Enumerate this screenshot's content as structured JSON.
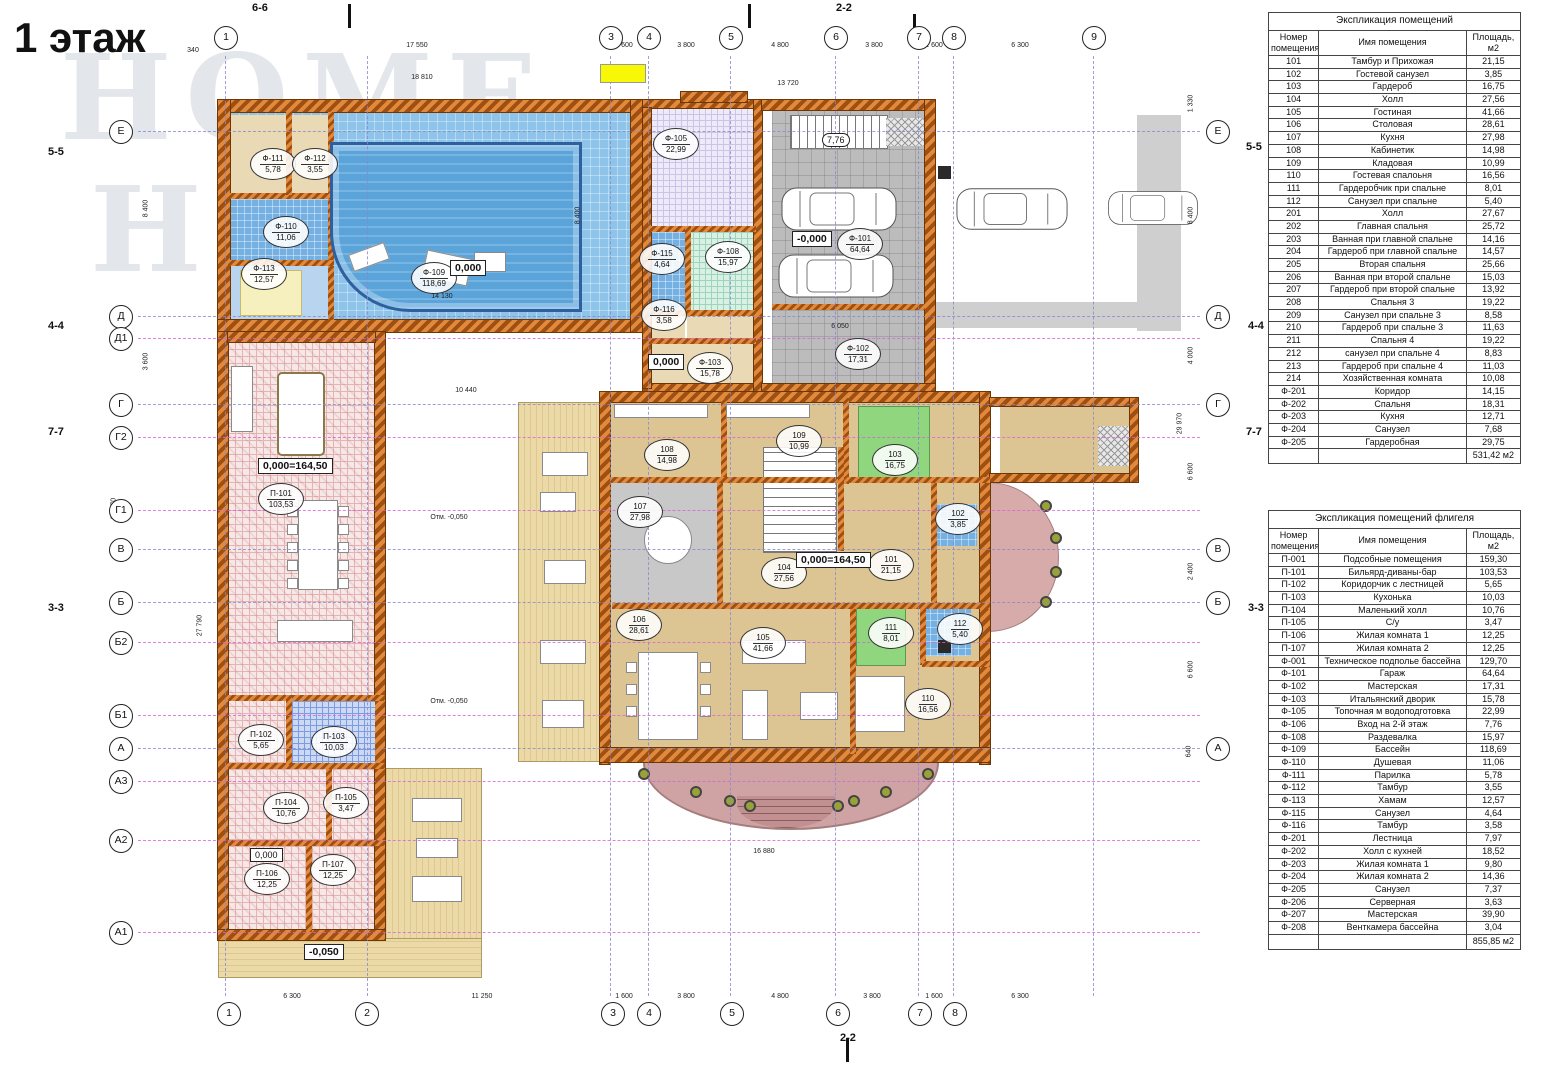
{
  "title": "1 этаж",
  "watermark": {
    "line1": "HOME",
    "line2": "HUNTER"
  },
  "colors": {
    "wall_orange": "#c8601a",
    "pool_blue": "#5aa4da",
    "pool_room": "#8ec3ea",
    "garage_gray": "#bcbcbc",
    "floor_tan": "#dcc593",
    "wing_pink": "#f7e8e8",
    "green_room": "#8fd67e",
    "bath_blue": "#74b0e2",
    "terrace_pink": "#cfa3a3",
    "deck_wood": "#ecd9a8",
    "highlight_yellow": "#f8f806",
    "grid_blue": "#8888cc",
    "grid_magenta": "#d664d6"
  },
  "axes": {
    "top": [
      "1",
      "3",
      "4",
      "5",
      "6",
      "7",
      "8",
      "9"
    ],
    "bottom": [
      "1",
      "2",
      "3",
      "4",
      "5",
      "6",
      "7",
      "8"
    ],
    "left": [
      "Е",
      "Д",
      "Д1",
      "Г",
      "Г2",
      "Г1",
      "В",
      "Б",
      "Б2",
      "Б1",
      "А",
      "А3",
      "А2",
      "А1"
    ],
    "right": [
      "Е",
      "Д",
      "Г",
      "В",
      "Б",
      "А"
    ]
  },
  "sections": {
    "s55": "5-5",
    "s44": "4-4",
    "s77": "7-7",
    "s33": "3-3",
    "s66": "6-6",
    "s22": "2-2"
  },
  "levels": {
    "pool": "0,000",
    "court": "0,000",
    "garage": "-0,000",
    "house": "0,000=164,50",
    "wing": "0,000=164,50",
    "p106": "0,000",
    "deck": "-0,050",
    "stair": "7,76",
    "otm": "Отм. -0,050"
  },
  "dims": {
    "top": [
      "340",
      "17 550",
      "1 600",
      "3 800",
      "4 800",
      "3 800",
      "1 600",
      "6 300"
    ],
    "top2": [
      "18 810",
      "13 720"
    ],
    "bottom": [
      "6 300",
      "11 250",
      "1 600",
      "3 800",
      "4 800",
      "3 800",
      "1 600",
      "6 300"
    ],
    "left": [
      "8 400",
      "3 600",
      "38 770",
      "27 790"
    ],
    "right": [
      "1 330",
      "8 400",
      "4 000",
      "6 600",
      "2 400",
      "6 600",
      "640",
      "29 970"
    ],
    "inner": [
      "14 130",
      "10 440",
      "16 880",
      "6 050",
      "8 400"
    ]
  },
  "rooms": {
    "f101": {
      "id": "Ф-101",
      "area": "64,64"
    },
    "f102": {
      "id": "Ф-102",
      "area": "17,31"
    },
    "f103": {
      "id": "Ф-103",
      "area": "15,78"
    },
    "f105": {
      "id": "Ф-105",
      "area": "22,99"
    },
    "f108": {
      "id": "Ф-108",
      "area": "15,97"
    },
    "f109": {
      "id": "Ф-109",
      "area": "118,69"
    },
    "f110": {
      "id": "Ф-110",
      "area": "11,06"
    },
    "f111": {
      "id": "Ф-111",
      "area": "5,78"
    },
    "f112": {
      "id": "Ф-112",
      "area": "3,55"
    },
    "f113": {
      "id": "Ф-113",
      "area": "12,57"
    },
    "f115": {
      "id": "Ф-115",
      "area": "4,64"
    },
    "f116": {
      "id": "Ф-116",
      "area": "3,58"
    },
    "r101": {
      "id": "101",
      "area": "21,15"
    },
    "r102": {
      "id": "102",
      "area": "3,85"
    },
    "r103": {
      "id": "103",
      "area": "16,75"
    },
    "r104": {
      "id": "104",
      "area": "27,56"
    },
    "r105": {
      "id": "105",
      "area": "41,66"
    },
    "r106": {
      "id": "106",
      "area": "28,61"
    },
    "r107": {
      "id": "107",
      "area": "27,98"
    },
    "r108": {
      "id": "108",
      "area": "14,98"
    },
    "r109": {
      "id": "109",
      "area": "10,99"
    },
    "r110": {
      "id": "110",
      "area": "16,56"
    },
    "r111": {
      "id": "111",
      "area": "8,01"
    },
    "r112": {
      "id": "112",
      "area": "5,40"
    },
    "p101": {
      "id": "П-101",
      "area": "103,53"
    },
    "p102": {
      "id": "П-102",
      "area": "5,65"
    },
    "p103": {
      "id": "П-103",
      "area": "10,03"
    },
    "p104": {
      "id": "П-104",
      "area": "10,76"
    },
    "p105": {
      "id": "П-105",
      "area": "3,47"
    },
    "p106": {
      "id": "П-106",
      "area": "12,25"
    },
    "p107": {
      "id": "П-107",
      "area": "12,25"
    }
  },
  "tables": [
    {
      "title": "Экспликация помещений",
      "headers": [
        "Номер помещения",
        "Имя помещения",
        "Площадь, м2"
      ],
      "rows": [
        [
          "101",
          "Тамбур и Прихожая",
          "21,15"
        ],
        [
          "102",
          "Гостевой санузел",
          "3,85"
        ],
        [
          "103",
          "Гардероб",
          "16,75"
        ],
        [
          "104",
          "Холл",
          "27,56"
        ],
        [
          "105",
          "Гостиная",
          "41,66"
        ],
        [
          "106",
          "Столовая",
          "28,61"
        ],
        [
          "107",
          "Кухня",
          "27,98"
        ],
        [
          "108",
          "Кабинетик",
          "14,98"
        ],
        [
          "109",
          "Кладовая",
          "10,99"
        ],
        [
          "110",
          "Гостевая спалоьня",
          "16,56"
        ],
        [
          "111",
          "Гардеробчик при спальне",
          "8,01"
        ],
        [
          "112",
          "Санузел при спальне",
          "5,40"
        ],
        [
          "201",
          "Холл",
          "27,67"
        ],
        [
          "202",
          "Главная спальня",
          "25,72"
        ],
        [
          "203",
          "Ванная при главной спальне",
          "14,16"
        ],
        [
          "204",
          "Гардероб при главной спальне",
          "14,57"
        ],
        [
          "205",
          "Вторая спальня",
          "25,66"
        ],
        [
          "206",
          "Ванная при второй спальне",
          "15,03"
        ],
        [
          "207",
          "Гардероб при второй спальне",
          "13,92"
        ],
        [
          "208",
          "Спальня 3",
          "19,22"
        ],
        [
          "209",
          "Санузел при спальне 3",
          "8,58"
        ],
        [
          "210",
          "Гардероб при спальне 3",
          "11,63"
        ],
        [
          "211",
          "Спальня 4",
          "19,22"
        ],
        [
          "212",
          "санузел при спальне 4",
          "8,83"
        ],
        [
          "213",
          "Гардероб при спальне 4",
          "11,03"
        ],
        [
          "214",
          "Хозяйственная комната",
          "10,08"
        ],
        [
          "Ф-201",
          "Коридор",
          "14,15"
        ],
        [
          "Ф-202",
          "Спальня",
          "18,31"
        ],
        [
          "Ф-203",
          "Кухня",
          "12,71"
        ],
        [
          "Ф-204",
          "Санузел",
          "7,68"
        ],
        [
          "Ф-205",
          "Гардеробная",
          "29,75"
        ]
      ],
      "total": "531,42 м2"
    },
    {
      "title": "Экспликация помещений флигеля",
      "headers": [
        "Номер помещения",
        "Имя помещения",
        "Площадь, м2"
      ],
      "rows": [
        [
          "П-001",
          "Подсобные помещения",
          "159,30"
        ],
        [
          "П-101",
          "Бильярд-диваны-бар",
          "103,53"
        ],
        [
          "П-102",
          "Коридорчик с лестницей",
          "5,65"
        ],
        [
          "П-103",
          "Кухонька",
          "10,03"
        ],
        [
          "П-104",
          "Маленький холл",
          "10,76"
        ],
        [
          "П-105",
          "С/у",
          "3,47"
        ],
        [
          "П-106",
          "Жилая комната 1",
          "12,25"
        ],
        [
          "П-107",
          "Жилая комната 2",
          "12,25"
        ],
        [
          "Ф-001",
          "Техническое подполье бассейна",
          "129,70"
        ],
        [
          "Ф-101",
          "Гараж",
          "64,64"
        ],
        [
          "Ф-102",
          "Мастерская",
          "17,31"
        ],
        [
          "Ф-103",
          "Итальянский дворик",
          "15,78"
        ],
        [
          "Ф-105",
          "Топочная м водоподготовка",
          "22,99"
        ],
        [
          "Ф-106",
          "Вход на 2-й этаж",
          "7,76"
        ],
        [
          "Ф-108",
          "Раздевалка",
          "15,97"
        ],
        [
          "Ф-109",
          "Бассейн",
          "118,69"
        ],
        [
          "Ф-110",
          "Душевая",
          "11,06"
        ],
        [
          "Ф-111",
          "Парилка",
          "5,78"
        ],
        [
          "Ф-112",
          "Тамбур",
          "3,55"
        ],
        [
          "Ф-113",
          "Хамам",
          "12,57"
        ],
        [
          "Ф-115",
          "Санузел",
          "4,64"
        ],
        [
          "Ф-116",
          "Тамбур",
          "3,58"
        ],
        [
          "Ф-201",
          "Лестница",
          "7,97"
        ],
        [
          "Ф-202",
          "Холл с кухней",
          "18,52"
        ],
        [
          "Ф-203",
          "Жилая комната 1",
          "9,80"
        ],
        [
          "Ф-204",
          "Жилая комната 2",
          "14,36"
        ],
        [
          "Ф-205",
          "Санузел",
          "7,37"
        ],
        [
          "Ф-206",
          "Серверная",
          "3,63"
        ],
        [
          "Ф-207",
          "Мастерская",
          "39,90"
        ],
        [
          "Ф-208",
          "Венткамера бассейна",
          "3,04"
        ]
      ],
      "total": "855,85 м2"
    }
  ]
}
